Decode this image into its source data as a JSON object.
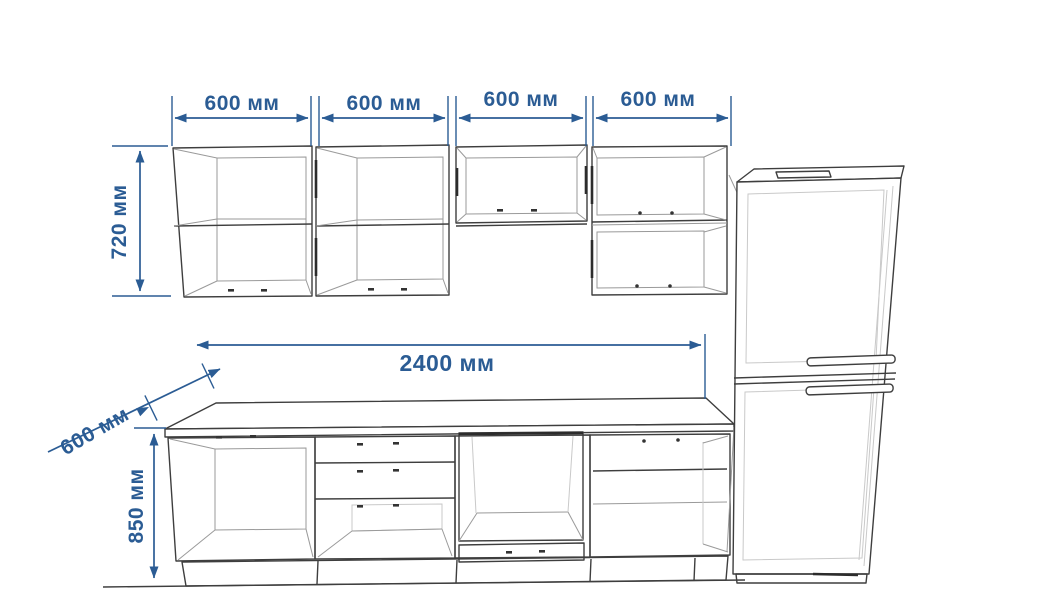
{
  "drawing": {
    "dimensions": {
      "wall_cabinet_widths": [
        "600 мм",
        "600 мм",
        "600 мм",
        "600 мм"
      ],
      "wall_cabinet_height": "720 мм",
      "total_length": "2400 мм",
      "countertop_depth": "600 мм",
      "base_cabinet_height": "850 мм"
    },
    "colors": {
      "dimension_blue": "#2b5c94",
      "outline": "#3e3e3e",
      "interior_line": "#9a9a9a",
      "light_line": "#c9c9c9",
      "background": "#ffffff"
    }
  }
}
